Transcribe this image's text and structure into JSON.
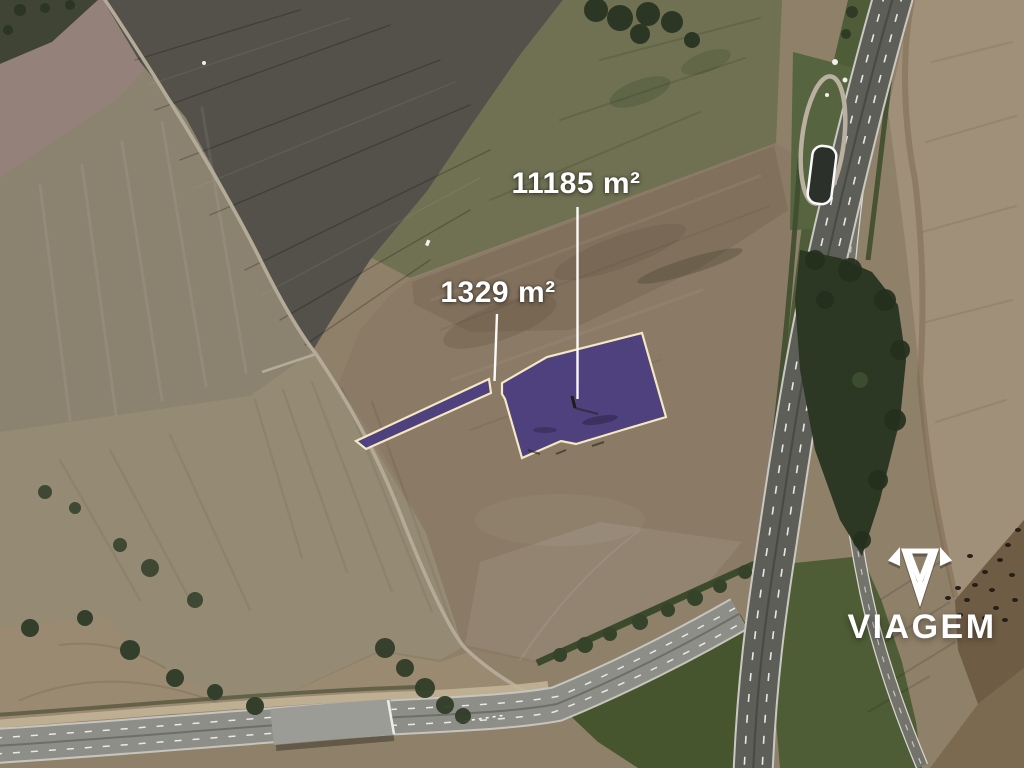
{
  "map": {
    "kind": "satellite-aerial-photo",
    "parcels": [
      {
        "id": "main",
        "area_label": "11185 m²"
      },
      {
        "id": "strip",
        "area_label": "1329 m²"
      }
    ],
    "colors": {
      "parcel_fill": "#4a3b80",
      "parcel_outline": "#f3e8c2",
      "leader": "#ffffff",
      "label_text": "#ffffff"
    }
  },
  "watermark": {
    "brand": "VIAGEM",
    "icon": "gem-diamond-icon",
    "color": "#ffffff"
  }
}
